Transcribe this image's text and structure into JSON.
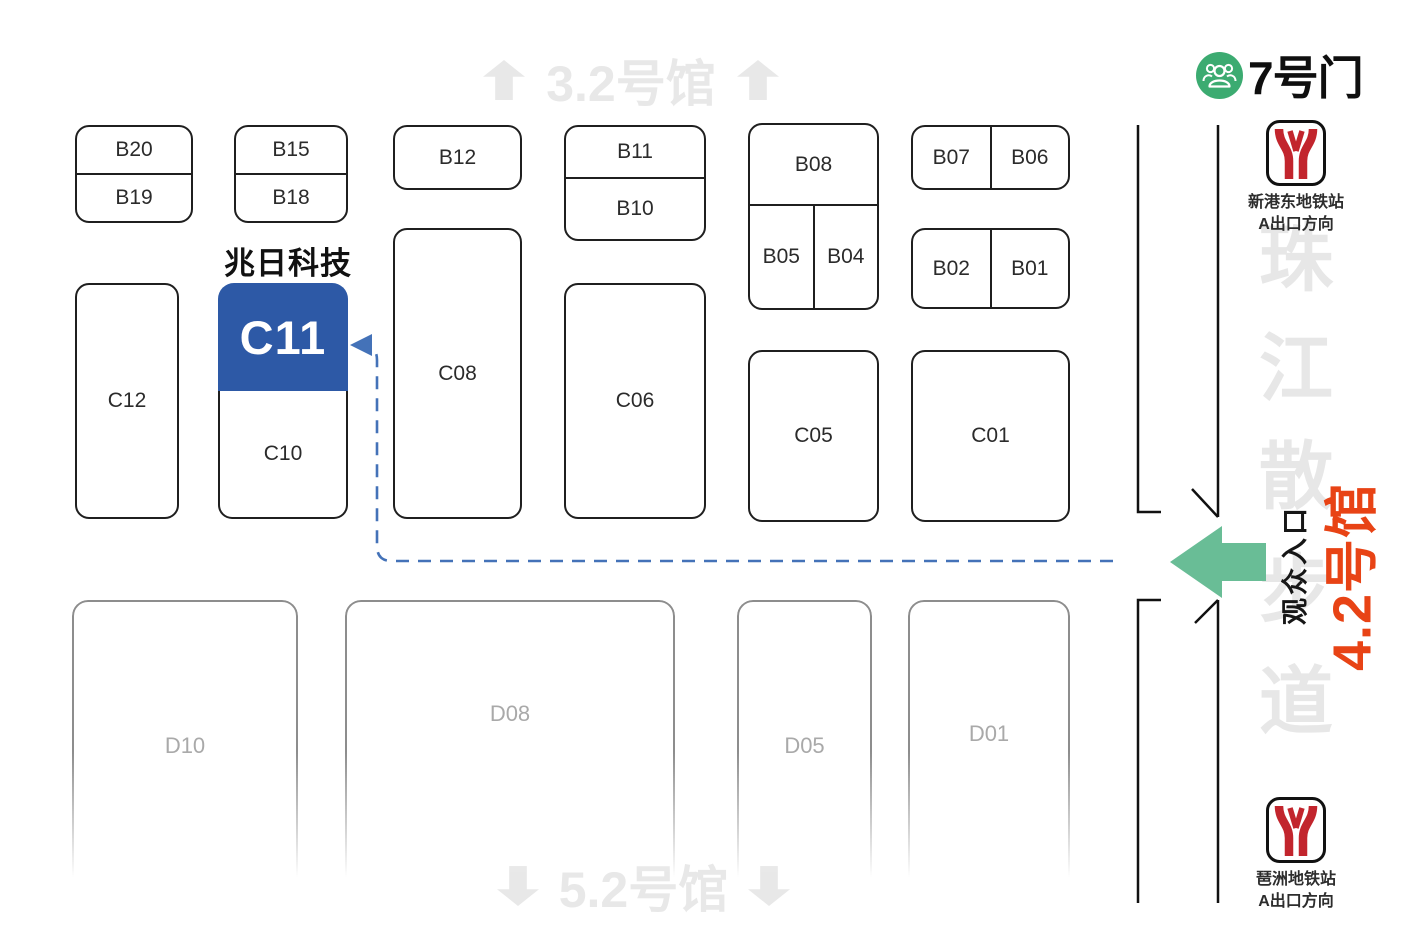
{
  "halls": {
    "top": "3.2号馆",
    "bottom": "5.2号馆",
    "right": "4.2号馆"
  },
  "gate": {
    "label": "7号门"
  },
  "company": {
    "name": "兆日科技",
    "booth": "C11"
  },
  "entrance": {
    "label": "观众入口"
  },
  "walkway": {
    "label": "珠江散步道",
    "chars": [
      "珠",
      "江",
      "散",
      "步",
      "道"
    ]
  },
  "metro": {
    "top": {
      "station": "新港东地铁站",
      "direction": "A出口方向"
    },
    "bottom": {
      "station": "琶洲地铁站",
      "direction": "A出口方向"
    }
  },
  "booths": {
    "b20": "B20",
    "b19": "B19",
    "b15": "B15",
    "b18": "B18",
    "b12": "B12",
    "b11": "B11",
    "b10": "B10",
    "b08": "B08",
    "b05": "B05",
    "b04": "B04",
    "b07": "B07",
    "b06": "B06",
    "b02": "B02",
    "b01": "B01",
    "c12": "C12",
    "c11": "C11",
    "c10": "C10",
    "c08": "C08",
    "c06": "C06",
    "c05": "C05",
    "c01": "C01",
    "d10": "D10",
    "d08": "D08",
    "d05": "D05",
    "d01": "D01"
  },
  "colors": {
    "highlight_blue": "#2d59a6",
    "route_blue": "#4472b8",
    "arrow_green": "#69bd96",
    "gate_green": "#3cab71",
    "hall_orange": "#e84315",
    "metro_red": "#c2252d",
    "ghost_gray": "#e8e8e8"
  }
}
